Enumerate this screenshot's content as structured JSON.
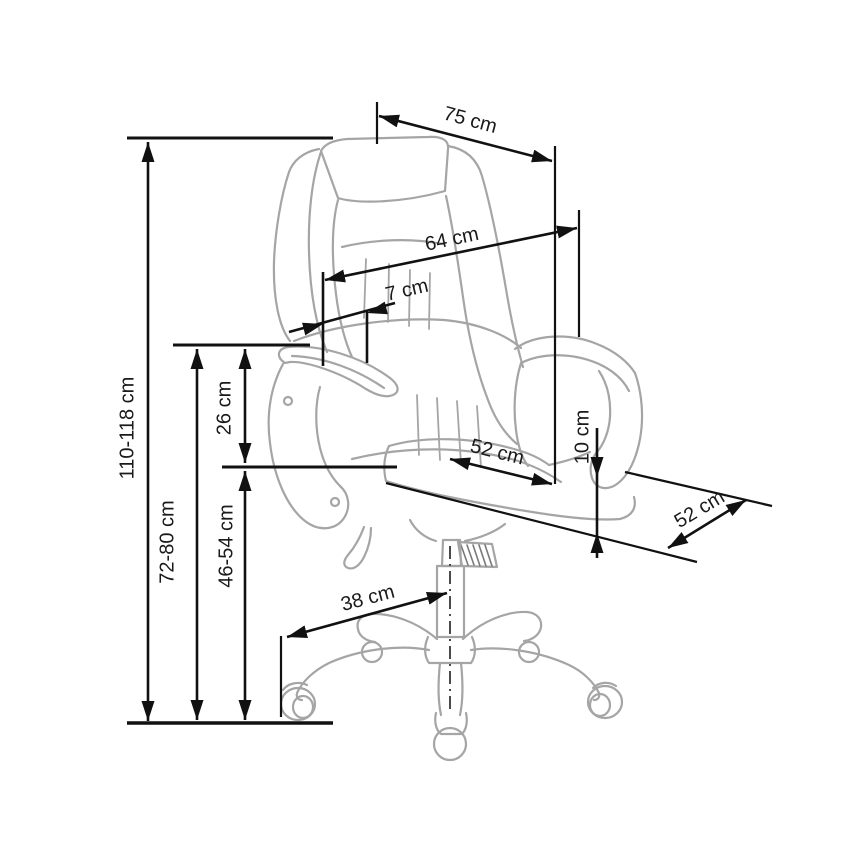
{
  "page": {
    "background": "#ffffff"
  },
  "unit": "cm",
  "colors": {
    "dimension_line": "#111111",
    "label_text": "#1a1a1a",
    "chair_line": "#a5a5a5",
    "hatch_line": "#7a7a7a",
    "centerline": "#4a4a4a"
  },
  "dimensions": {
    "total_height": {
      "label": "110-118 cm",
      "min": 110,
      "max": 118
    },
    "backrest_width": {
      "label": "75 cm",
      "value": 75
    },
    "backrest_height": {
      "label": "64 cm",
      "value": 64
    },
    "headrest_thickness": {
      "label": "7 cm",
      "value": 7
    },
    "armrest_height": {
      "label": "72-80 cm",
      "min": 72,
      "max": 80
    },
    "armrest_to_seat": {
      "label": "26 cm",
      "value": 26
    },
    "seat_height": {
      "label": "46-54 cm",
      "min": 46,
      "max": 54
    },
    "seat_width": {
      "label": "52 cm",
      "value": 52
    },
    "seat_cushion": {
      "label": "10 cm",
      "value": 10
    },
    "seat_depth": {
      "label": "52 cm",
      "value": 52
    },
    "base_radius": {
      "label": "38 cm",
      "value": 38
    }
  }
}
